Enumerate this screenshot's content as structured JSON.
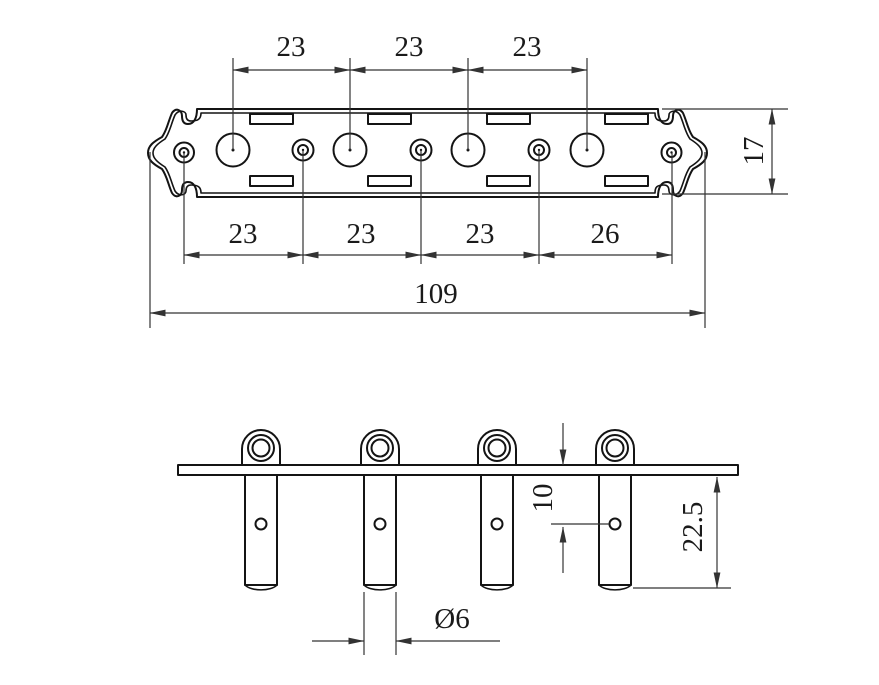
{
  "top_view": {
    "dims_top_spacing": [
      "23",
      "23",
      "23"
    ],
    "dims_bottom_spacing": [
      "23",
      "23",
      "23",
      "26"
    ],
    "dim_overall_length": "109",
    "dim_plate_width": "17"
  },
  "side_view": {
    "dim_hole_offset": "10",
    "dim_post_length": "22.5",
    "dim_post_diameter": "Ø6"
  },
  "colors": {
    "background": "#ffffff",
    "object_line": "#141414",
    "dimension_line": "#333333",
    "text": "#1a1a1a"
  }
}
